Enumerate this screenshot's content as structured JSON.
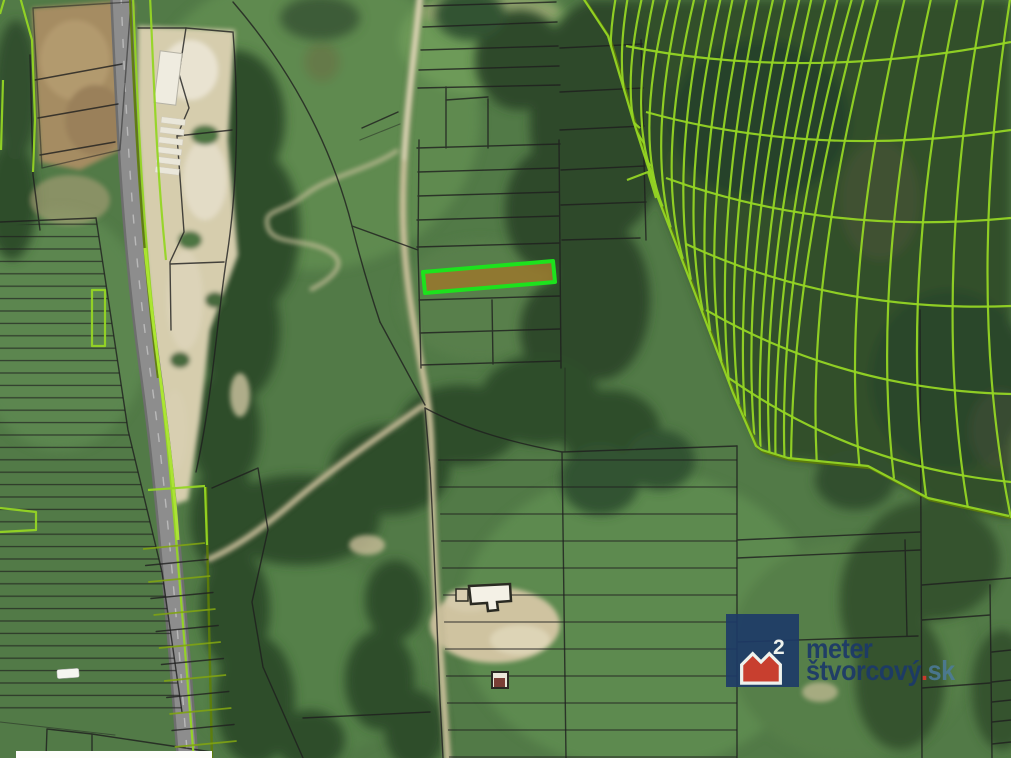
{
  "watermark": {
    "line1": "meter",
    "line2_word": "štvorcový",
    "line2_dot": ".",
    "line2_tld": "sk",
    "icon_exponent": "2",
    "colors": {
      "navy": "#1d3a69",
      "red": "#d5392d",
      "tld": "#4d7c9e",
      "white": "#ffffff"
    }
  },
  "map": {
    "colors": {
      "field": "#527a47",
      "field_light": "#5f8a4f",
      "forest": "#2e4b2b",
      "forest_dark": "#27422a",
      "sand": "#d6cdad",
      "plow": "#a58c62",
      "road": "#8d8d8d",
      "trail": "#cfc49f",
      "parcel_line": "#1f1f1f",
      "cadastre_yellow": "#95d524",
      "cadastre_olive": "#5e7d08",
      "highlight_stroke": "#1de21d",
      "highlight_fill": "#97782e"
    },
    "highlighted_parcel": {
      "present": true
    }
  }
}
